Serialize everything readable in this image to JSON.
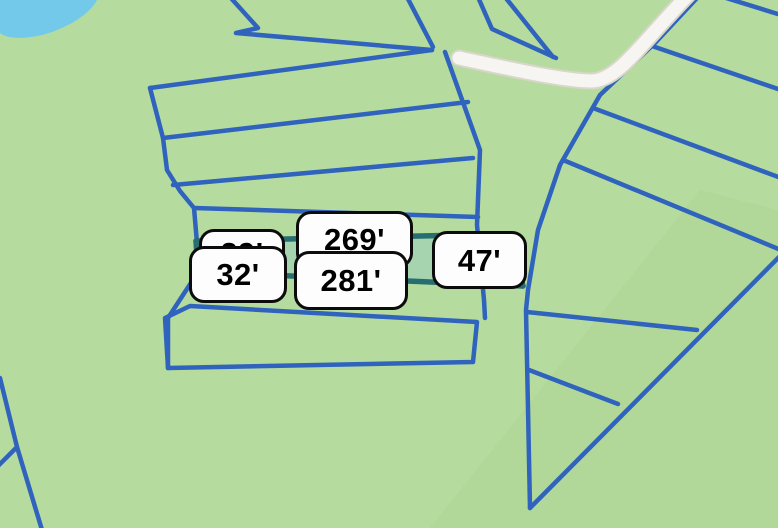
{
  "window": {
    "width": 778,
    "height": 528
  },
  "map": {
    "description": "Parcel-boundary map with a selected lot whose edge lengths are labeled",
    "colors": {
      "land": "#b6db9e",
      "land_shade": "#a9d18f",
      "water": "#72c9e9",
      "parcel_line": "#2f63bd",
      "selected_edge": "#276e70",
      "selected_fill": "#a6d4ae",
      "road_fill": "#f6f5f1",
      "road_edge": "#d9d6cc",
      "label_bg": "#fdfdfd",
      "label_border": "#0c0c0c",
      "label_text": "#000000"
    },
    "features": {
      "water_body": "pond at top-left corner",
      "road": "white unnamed road, upper right",
      "parcels": "blue lot boundary lines",
      "selected_lot": "thin strip outlined in dark teal"
    }
  },
  "measurements": [
    {
      "edge": "left-upper",
      "text": "29'",
      "obscured": true
    },
    {
      "edge": "left",
      "text": "32'"
    },
    {
      "edge": "top",
      "text": "269'"
    },
    {
      "edge": "bottom",
      "text": "281'"
    },
    {
      "edge": "right",
      "text": "47'"
    }
  ]
}
